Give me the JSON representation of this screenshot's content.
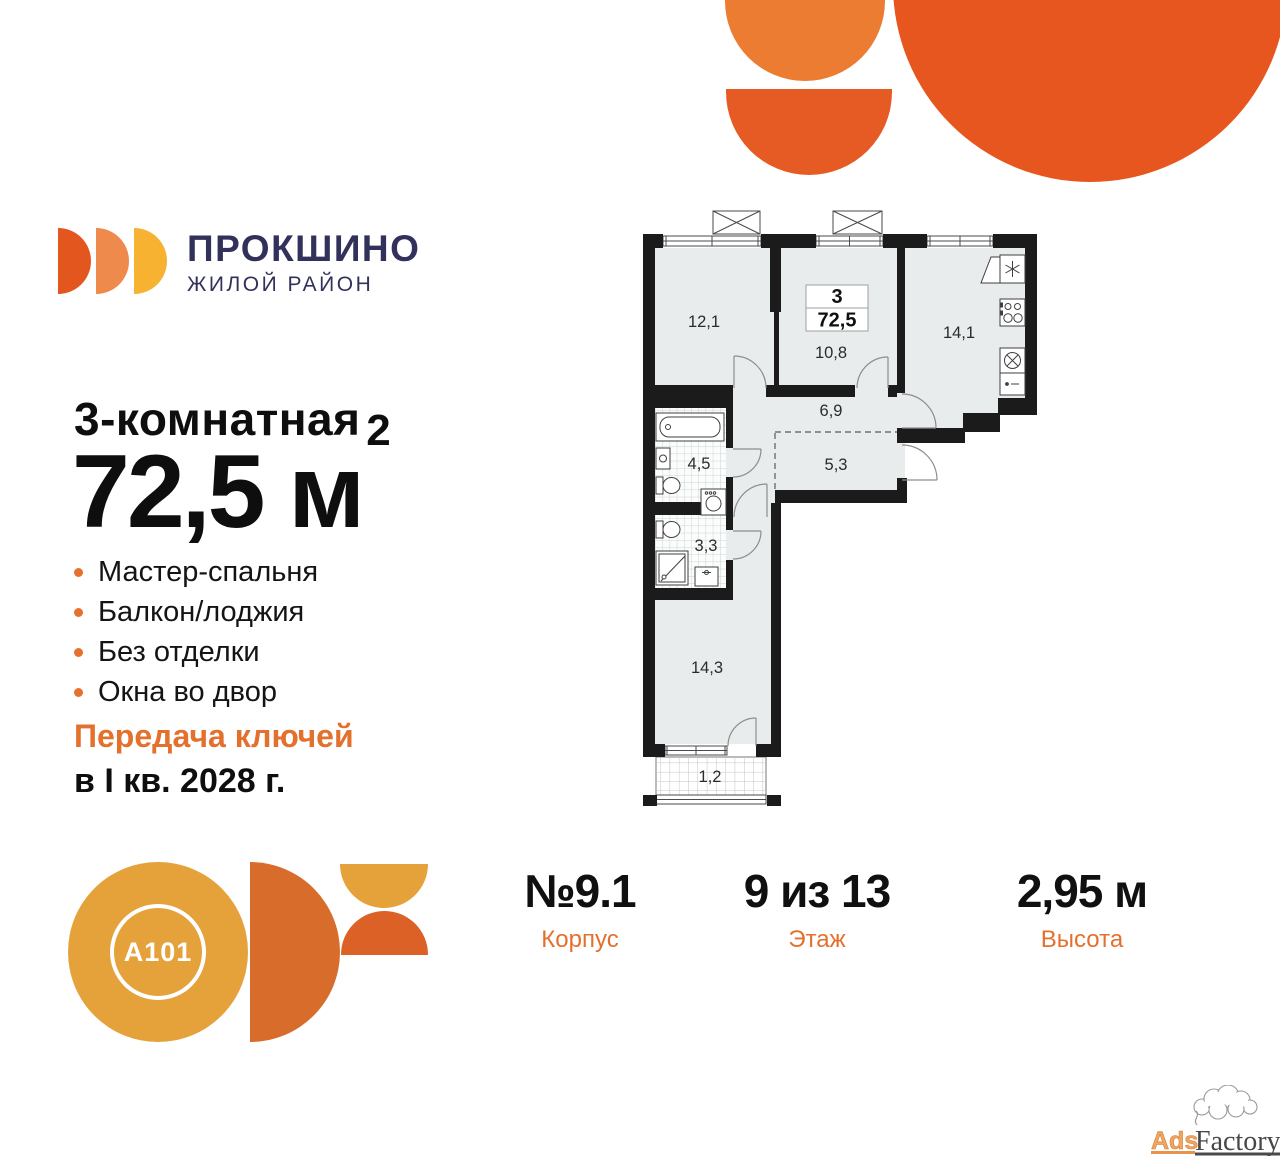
{
  "brand": {
    "wordmark": "ПРОКШИНО",
    "tagline": "ЖИЛОЙ РАЙОН"
  },
  "listing": {
    "rooms_title": "3-комнатная",
    "area_text": "72,5 м",
    "area_sup": "2",
    "features": [
      "Мастер-спальня",
      "Балкон/лоджия",
      "Без отделки",
      "Окна во двор"
    ],
    "handover_accent": "Передача ключей",
    "handover_date": "в I кв. 2028 г."
  },
  "plan": {
    "info_rooms": "3",
    "info_area": "72,5",
    "rooms": [
      {
        "name": "bedroom-1",
        "area": "12,1"
      },
      {
        "name": "bedroom-2",
        "area": "10,8"
      },
      {
        "name": "kitchen",
        "area": "14,1"
      },
      {
        "name": "hallway",
        "area": "6,9"
      },
      {
        "name": "bathroom",
        "area": "4,5"
      },
      {
        "name": "corridor",
        "area": "5,3"
      },
      {
        "name": "wc",
        "area": "3,3"
      },
      {
        "name": "master-bedroom",
        "area": "14,3"
      },
      {
        "name": "balcony",
        "area": "1,2"
      }
    ]
  },
  "details": [
    {
      "value": "№9.1",
      "label": "Корпус"
    },
    {
      "value": "9 из 13",
      "label": "Этаж"
    },
    {
      "value": "2,95 м",
      "label": "Высота"
    }
  ],
  "developer": {
    "logo_text": "A101"
  },
  "watermark": {
    "part1": "Ads",
    "part2": "Factory"
  },
  "colors": {
    "accent_orange": "#E4702E",
    "navy": "#32315B",
    "decor_circle": "#E7561E",
    "decor_semicircle_dark": "#E65B24",
    "decor_semicircle_light": "#EC7C31",
    "logo_d_dark": "#E3571E",
    "logo_d_mid": "#EF8A4D",
    "logo_d_yellow": "#F6B230",
    "a101_yellow": "#E5A23B",
    "a101_orange": "#D86C2B",
    "a101_halfdisc_orange": "#DB6127",
    "plan_wall": "#1B1B1B",
    "plan_room_fill": "#E9ECED"
  }
}
